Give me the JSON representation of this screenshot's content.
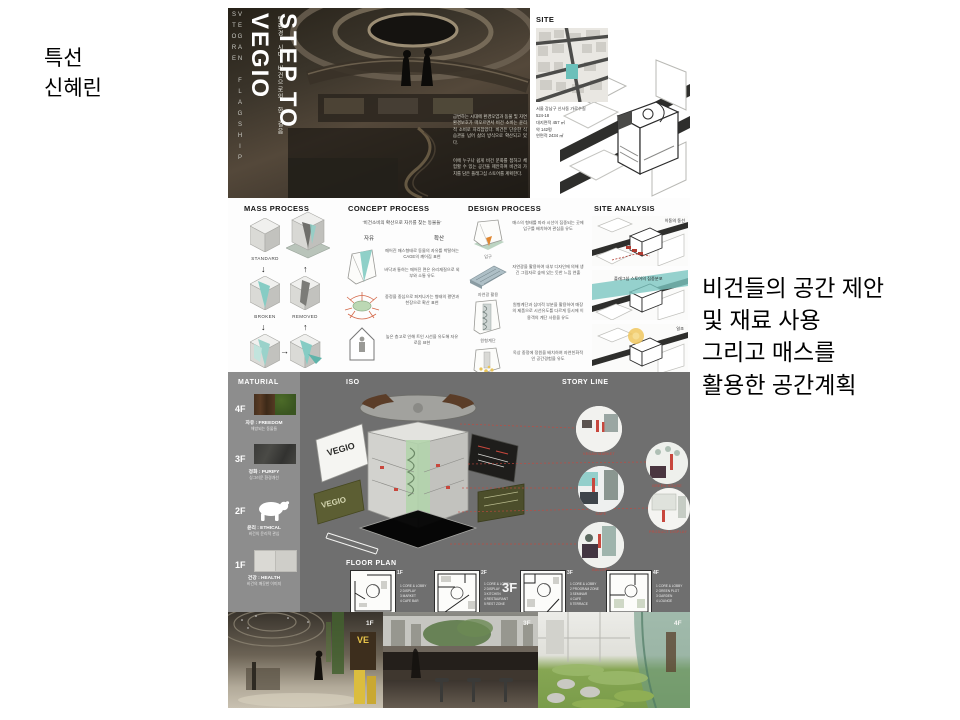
{
  "colors": {
    "accent_teal": "#6cc0ba",
    "panel_gray": "#6f6f6f",
    "sidebar_gray": "#8d8d8d",
    "accent_red": "#c0392b",
    "olive_green": "#5c5e33",
    "accent_yellow": "#e9c54b"
  },
  "left_label": {
    "line1": "특선",
    "line2": "신혜린"
  },
  "right_note": {
    "line1": "비건들의 공간 제안",
    "line2": "및 재료 사용",
    "line3": "그리고 매스를",
    "line4": "활용한 공간계획"
  },
  "hero": {
    "side_vertical": "VEGAN FLAGSHIP STORE",
    "title": "STEP TO VEGIO",
    "subtitle": "탈환경 시대 비건으로의 한 걸음",
    "para1": "급변하는 시대에 환경오염과 동물 및 자연 환경보호가 떠오르면서 비건 소비는 윤리적 소비로 자리잡았다. 비건은 단순한 식습관을 넘어 삶의 방식으로 확산되고 있다.",
    "para2": "이에 누구나 쉽게 비건 문화를 접하고 체험할 수 있는 공간을 제안하며 비건의 가치를 담은 플래그십 스토어를 계획한다."
  },
  "site": {
    "header": "SITE",
    "address": "서울 강남구 신사동 가로수길\n524-18",
    "areas": "대지면적 457 ㎡\n약 142평\n연면적 2434 ㎡"
  },
  "mass": {
    "header": "MASS PROCESS",
    "standard": "STANDARD",
    "broken": "BROKEN",
    "removed": "REMOVED",
    "add_surface": "ADD SURFACE",
    "push": "PUSH"
  },
  "concept": {
    "header": "CONCEPT PROCESS",
    "quote": "'비건소비의 확산으로 자유를 찾는 동물들'",
    "label_free": "자유",
    "label_spread": "확산",
    "item1": "깨어진 매스형태로 동물의 자유를 박탈하는 CAGE의 깨어짐 표현\n\n바닥과 통하는 깨어진 면은 유리재질으로 외부와 소통 유도",
    "item2": "중정을 중심으로 퍼져나가는 형태의 평면과 천장으로 확산 표현",
    "item3": "높은 층고로 인해 트인 시선을 유도해 자유로움 표현"
  },
  "design": {
    "header": "DESIGN PROCESS",
    "rows": [
      {
        "caption": "입구",
        "text": "매스의 형태를 따라 시선이 집중되는 곳에 입구를 배치하여 관심을 유도"
      },
      {
        "caption": "자연광 활용",
        "text": "자연광을 활용하여 내부 디자인에 의해 생긴 그림자로 숲에 있는 듯한 느낌 연출"
      },
      {
        "caption": "원형계단",
        "text": "원형계단과 심미적 부분을 활용하여 매장의 제품으로 시선유도를 다르게 동시에 이용객의 계단 사용을 유도"
      },
      {
        "caption": "중앙정원",
        "text": "옥상 중정에 정원을 배치하여 자연친화적인 공간경험을 유도"
      }
    ]
  },
  "analysis": {
    "header": "SITE ANALYSIS",
    "d1": "이동의 동선",
    "d2": "플래그십 스토어의 집중분포",
    "d3": "일조"
  },
  "material": {
    "header": "MATURIAL",
    "floors": [
      {
        "level": "4F",
        "title": "자유 : FREEDOM",
        "sub": "해방되는 동물들"
      },
      {
        "level": "3F",
        "title": "정화 : PURIFY",
        "sub": "싱그러운 환경개선"
      },
      {
        "level": "2F",
        "title": "윤리 : ETHICAL",
        "sub": "비건의 윤리적 관심"
      },
      {
        "level": "1F",
        "title": "건강 : HEALTH",
        "sub": "비건의 깨끗한 이미지"
      }
    ]
  },
  "iso": {
    "header": "ISO",
    "panel1": "VEGIO",
    "panel2": "VEGIO",
    "panel3": "VEGIO"
  },
  "story": {
    "header": "STORY LINE",
    "captions": [
      "VEGAN MARKET",
      "GREEN HOUSE",
      "CAFE",
      "PRODUCT DISPLAY",
      "GALLERY"
    ]
  },
  "plan": {
    "header": "FLOOR PLAN",
    "overlay_label": "3F",
    "items": [
      {
        "label": "1F",
        "legend": "1 CORE & LOBBY\n2 DISPLAY\n3 MARKET\n4 CAFE BAR"
      },
      {
        "label": "2F",
        "legend": "1 CORE & LOBBY\n2 DISPLAY\n3 KITCHEN\n4 RESTAURANT\n5 REST ZONE"
      },
      {
        "label": "3F",
        "legend": "1 CORE & LOBBY\n2 PROGRAM ZONE\n3 SEMINAR\n4 CAFE\n5 TERRACE"
      },
      {
        "label": "4F",
        "legend": "1 CORE & LOBBY\n2 GREEN PLOT\n3 GARDEN\n4 LOUNGE"
      }
    ]
  },
  "renders": {
    "ve_sign": "VE",
    "items": [
      {
        "label": "1F"
      },
      {
        "label": "3F"
      },
      {
        "label": "4F"
      }
    ]
  }
}
